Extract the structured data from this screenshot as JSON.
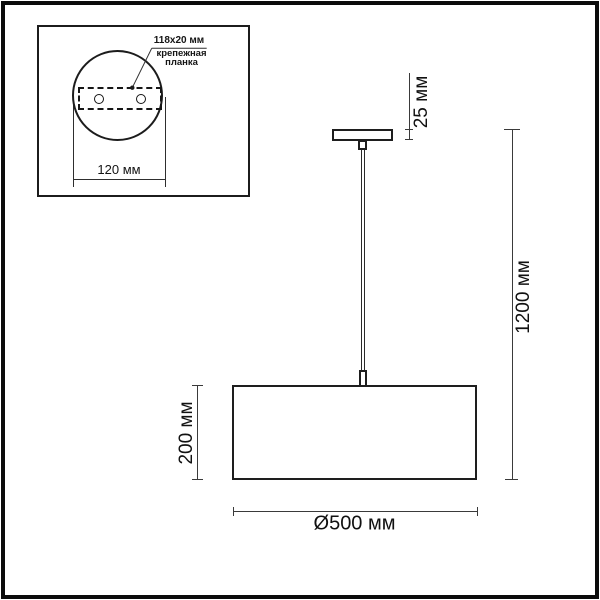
{
  "inset": {
    "plate_dimensions": "118x20 мм",
    "plate_label_line1": "крепежная",
    "plate_label_line2": "планка",
    "plate_width": "120 мм"
  },
  "pendant": {
    "canopy_height": "25 мм",
    "suspension_height": "1200 мм",
    "shade_height": "200 мм",
    "shade_diameter": "Ø500 мм"
  },
  "colors": {
    "frame": "#0b0b0b",
    "drawing_line": "#1e1e1e",
    "dimension_line": "#3a3a3a",
    "background": "#ffffff"
  }
}
